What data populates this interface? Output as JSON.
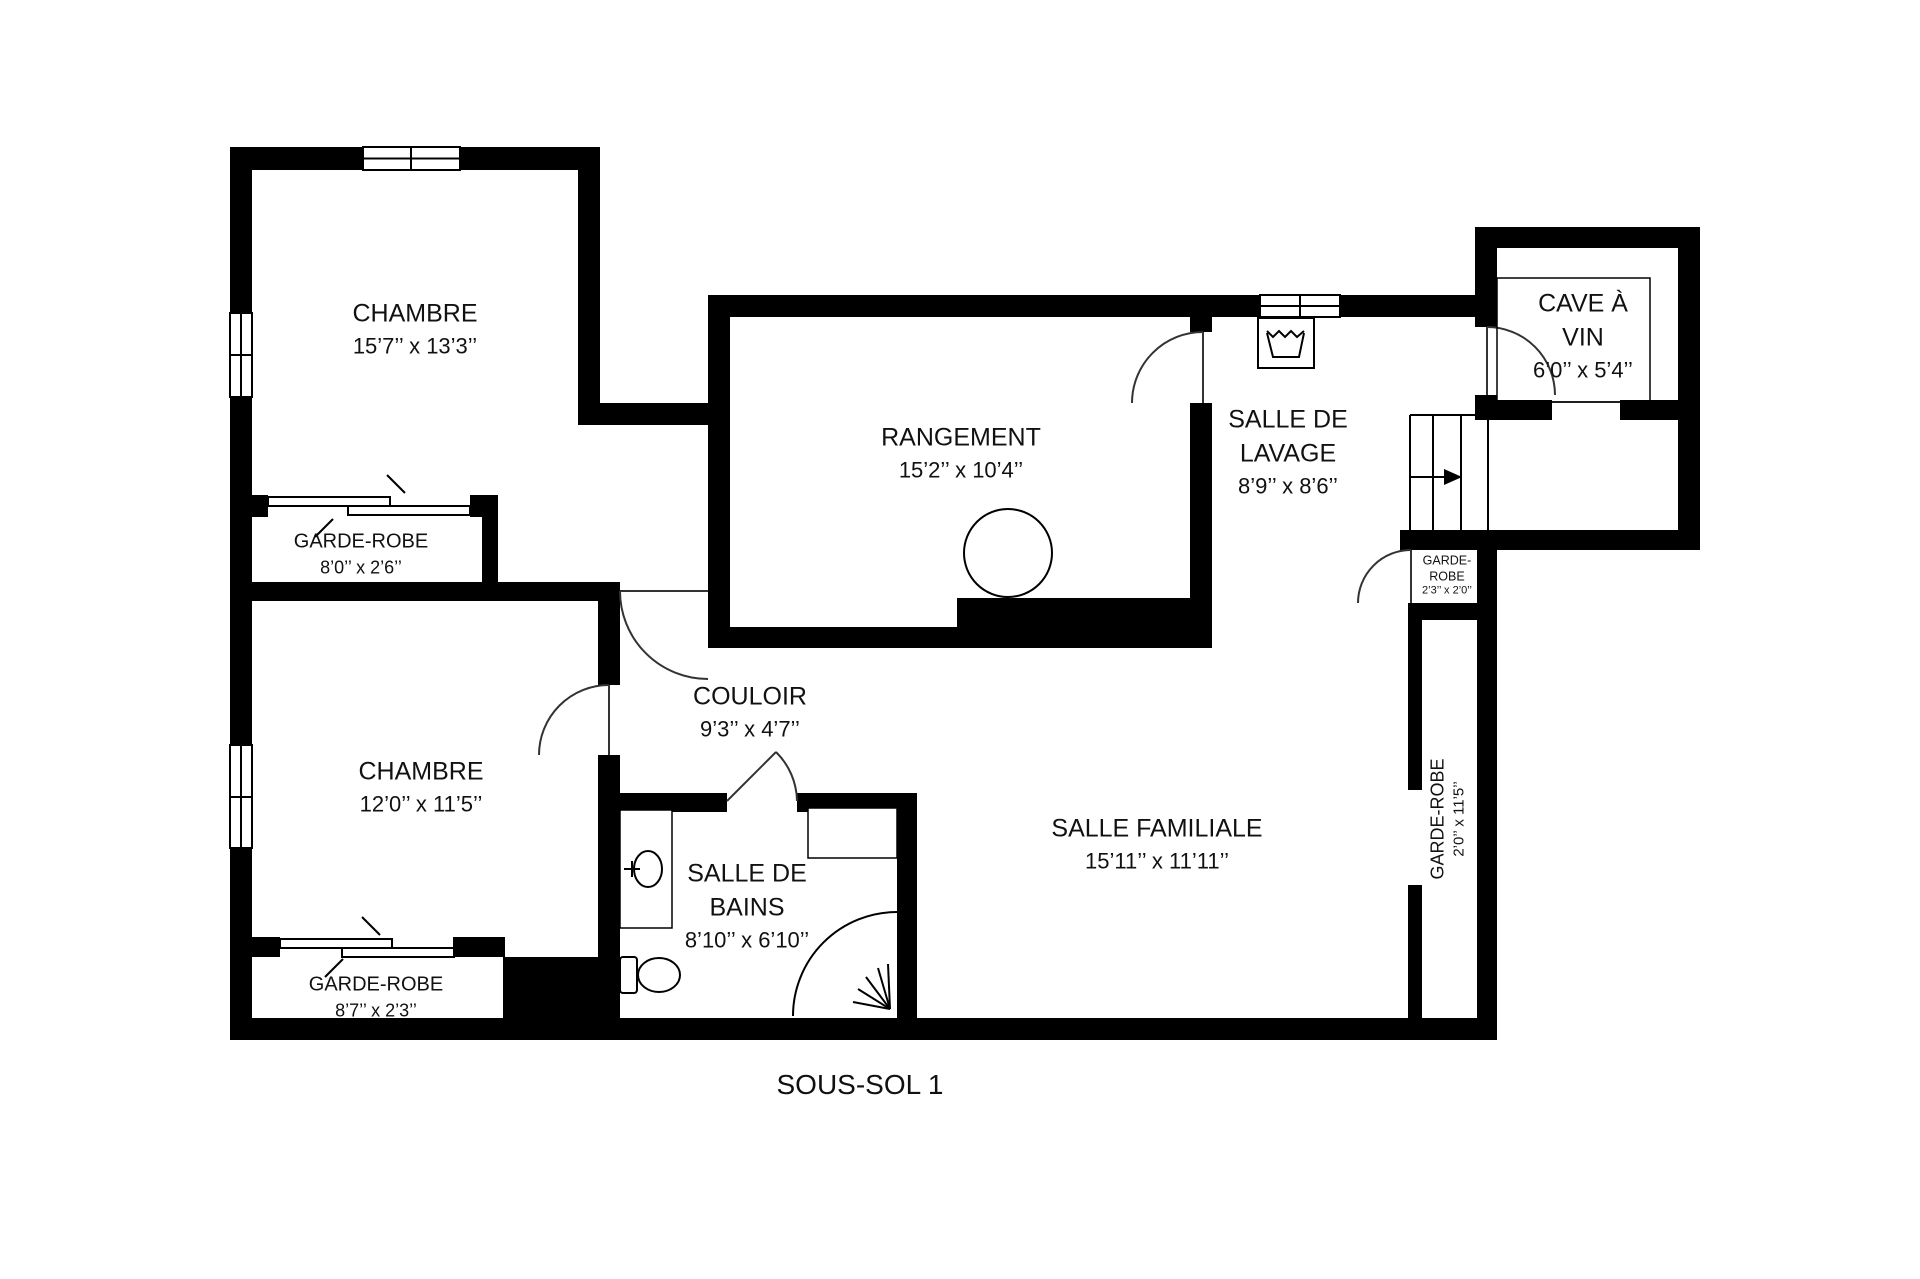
{
  "title": "SOUS-SOL 1",
  "colors": {
    "wall": "#000000",
    "background": "#ffffff",
    "text": "#111111",
    "thin_line": "#000000",
    "door_line": "#333333"
  },
  "rooms": {
    "chambre_top": {
      "name": "CHAMBRE",
      "dims": "15’7’’ x 13’3’’"
    },
    "garde_robe_top": {
      "name": "GARDE-ROBE",
      "dims": "8’0’’ x 2’6’’"
    },
    "chambre_bottom": {
      "name": "CHAMBRE",
      "dims": "12’0’’ x 11’5’’"
    },
    "garde_robe_bottom": {
      "name": "GARDE-ROBE",
      "dims": "8’7’’ x 2’3’’"
    },
    "rangement": {
      "name": "RANGEMENT",
      "dims": "15’2’’ x 10’4’’"
    },
    "couloir": {
      "name": "COULOIR",
      "dims": "9’3’’ x 4’7’’"
    },
    "salle_de_bains": {
      "line1": "SALLE DE",
      "line2": "BAINS",
      "dims": "8’10’’ x 6’10’’"
    },
    "salle_familiale": {
      "name": "SALLE FAMILIALE",
      "dims": "15’11’’ x 11’11’’"
    },
    "salle_de_lavage": {
      "line1": "SALLE DE",
      "line2": "LAVAGE",
      "dims": "8’9’’ x 8’6’’"
    },
    "cave_a_vin": {
      "line1": "CAVE À",
      "line2": "VIN",
      "dims": "6’0’’ x 5’4’’"
    },
    "garde_robe_small": {
      "line1": "GARDE-",
      "line2": "ROBE",
      "dims": "2’3’’ x 2’0’’"
    },
    "garde_robe_vertical": {
      "name": "GARDE-ROBE",
      "dims": "2’0’’ x 11’5’’"
    }
  },
  "icons": {
    "laundry_tub": "laundry-tub-icon",
    "water_heater": "water-heater-tank-icon",
    "bathroom_sink": "sink-icon",
    "toilet": "toilet-icon",
    "corner_shower": "corner-shower-icon",
    "stairs": "stairs-icon",
    "stairs_arrow": "stairs-direction-arrow",
    "windows": "window-symbol",
    "doors": "door-swing-symbol",
    "sliding_doors": "sliding-door-symbol"
  }
}
